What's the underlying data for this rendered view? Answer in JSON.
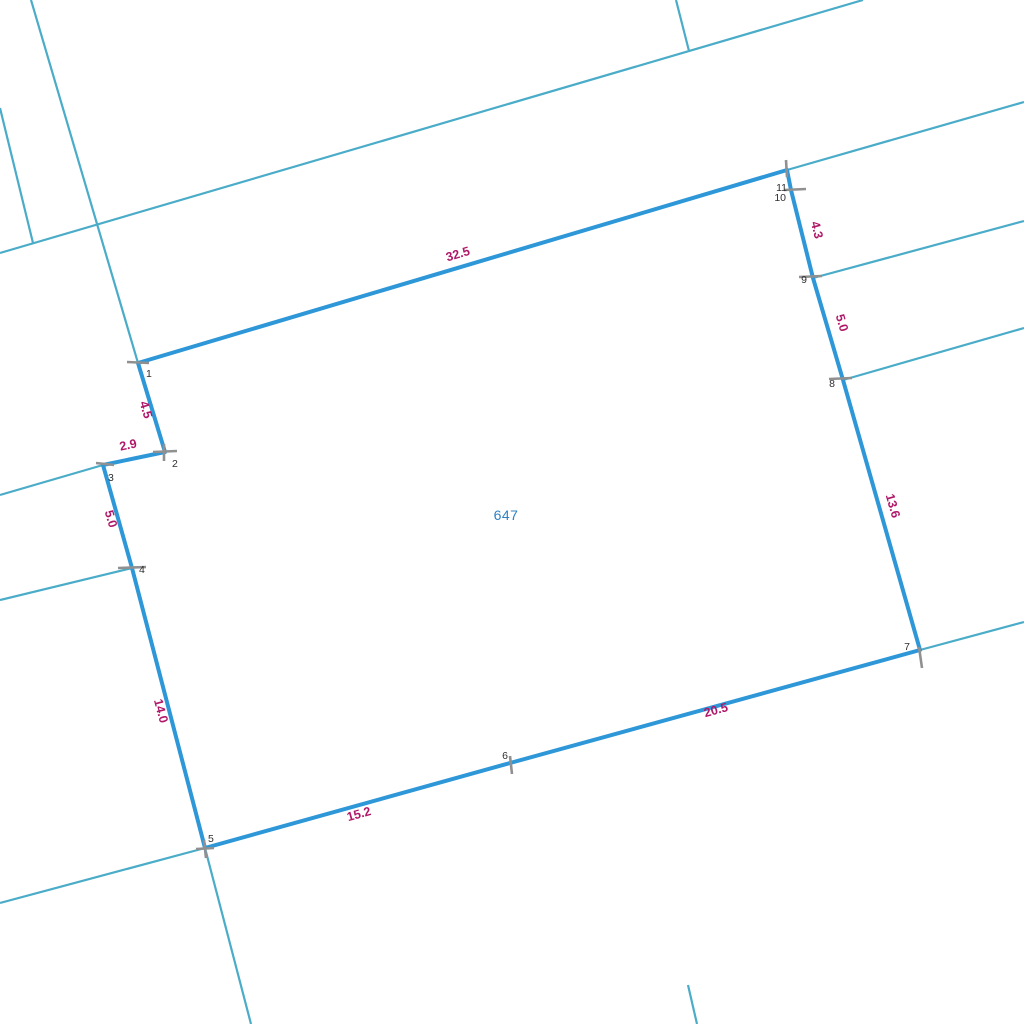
{
  "map": {
    "title": "cadastral parcel map",
    "canvas": {
      "width": 1024,
      "height": 1024,
      "background": "#ffffff"
    },
    "colors": {
      "parcel_boundary": "#2e97d8",
      "adjacent_boundary": "#4aacc8",
      "dimension_label": "#b01768",
      "vertex_label": "#2f2f2f",
      "tick": "#909090",
      "parcel_number": "#2f80c3"
    },
    "parcel": {
      "number": "647",
      "number_pos": {
        "x": 506,
        "y": 515
      },
      "vertices": [
        {
          "n": "1",
          "x": 138,
          "y": 363,
          "lx": 146,
          "ly": 377,
          "anchor": "start"
        },
        {
          "n": "2",
          "x": 165,
          "y": 452,
          "lx": 172,
          "ly": 467,
          "anchor": "start"
        },
        {
          "n": "3",
          "x": 103,
          "y": 465,
          "lx": 108,
          "ly": 481,
          "anchor": "start"
        },
        {
          "n": "4",
          "x": 132,
          "y": 568,
          "lx": 139,
          "ly": 573,
          "anchor": "start"
        },
        {
          "n": "5",
          "x": 205,
          "y": 848,
          "lx": 208,
          "ly": 842,
          "anchor": "start"
        },
        {
          "n": "6",
          "x": 510,
          "y": 763,
          "lx": 505,
          "ly": 759,
          "anchor": "middle"
        },
        {
          "n": "7",
          "x": 920,
          "y": 650,
          "lx": 910,
          "ly": 650,
          "anchor": "end"
        },
        {
          "n": "8",
          "x": 843,
          "y": 380,
          "lx": 835,
          "ly": 387,
          "anchor": "end"
        },
        {
          "n": "9",
          "x": 813,
          "y": 278,
          "lx": 807,
          "ly": 283,
          "anchor": "end"
        },
        {
          "n": "10",
          "x": 791,
          "y": 190,
          "lx": 786,
          "ly": 201,
          "anchor": "end"
        },
        {
          "n": "11",
          "x": 787,
          "y": 170,
          "lx": 787,
          "ly": 191,
          "anchor": "end"
        }
      ],
      "dimensions": [
        {
          "text": "32.5",
          "x": 459,
          "y": 258,
          "angle": -16.5
        },
        {
          "text": "4.3",
          "x": 813,
          "y": 231,
          "angle": 76
        },
        {
          "text": "5.0",
          "x": 838,
          "y": 324,
          "angle": 74
        },
        {
          "text": "13.6",
          "x": 889,
          "y": 507,
          "angle": 74
        },
        {
          "text": "20.5",
          "x": 717,
          "y": 714,
          "angle": -15.4
        },
        {
          "text": "15.2",
          "x": 360,
          "y": 818,
          "angle": -15.6
        },
        {
          "text": "14.0",
          "x": 157,
          "y": 712,
          "angle": 75
        },
        {
          "text": "5.0",
          "x": 107,
          "y": 520,
          "angle": 74
        },
        {
          "text": "2.9",
          "x": 129,
          "y": 449,
          "angle": -12
        },
        {
          "text": "4.5",
          "x": 142,
          "y": 411,
          "angle": 73
        }
      ]
    },
    "adjacent_lines": [
      {
        "x1": 31,
        "y1": 0,
        "x2": 138,
        "y2": 363
      },
      {
        "x1": 0,
        "y1": 108,
        "x2": 33,
        "y2": 243
      },
      {
        "x1": 0,
        "y1": 253,
        "x2": 863,
        "y2": 0
      },
      {
        "x1": 676,
        "y1": 0,
        "x2": 689,
        "y2": 51
      },
      {
        "x1": 1024,
        "y1": 102,
        "x2": 787,
        "y2": 170
      },
      {
        "x1": 813,
        "y1": 278,
        "x2": 1024,
        "y2": 221
      },
      {
        "x1": 843,
        "y1": 380,
        "x2": 1024,
        "y2": 328
      },
      {
        "x1": 920,
        "y1": 650,
        "x2": 1024,
        "y2": 622
      },
      {
        "x1": 0,
        "y1": 495,
        "x2": 103,
        "y2": 465
      },
      {
        "x1": 0,
        "y1": 600,
        "x2": 132,
        "y2": 568
      },
      {
        "x1": 0,
        "y1": 903,
        "x2": 205,
        "y2": 848
      },
      {
        "x1": 205,
        "y1": 848,
        "x2": 251,
        "y2": 1024
      },
      {
        "x1": 688,
        "y1": 985,
        "x2": 697,
        "y2": 1024
      }
    ],
    "ticks": [
      {
        "x1": 127,
        "y1": 362,
        "x2": 149,
        "y2": 363
      },
      {
        "x1": 153,
        "y1": 452,
        "x2": 177,
        "y2": 451
      },
      {
        "x1": 164,
        "y1": 444,
        "x2": 164,
        "y2": 461
      },
      {
        "x1": 96,
        "y1": 463,
        "x2": 114,
        "y2": 465
      },
      {
        "x1": 118,
        "y1": 568,
        "x2": 146,
        "y2": 567
      },
      {
        "x1": 196,
        "y1": 849,
        "x2": 214,
        "y2": 848
      },
      {
        "x1": 204,
        "y1": 840,
        "x2": 206,
        "y2": 858
      },
      {
        "x1": 510,
        "y1": 756,
        "x2": 512,
        "y2": 774
      },
      {
        "x1": 919,
        "y1": 647,
        "x2": 922,
        "y2": 668
      },
      {
        "x1": 829,
        "y1": 379,
        "x2": 852,
        "y2": 378
      },
      {
        "x1": 799,
        "y1": 277,
        "x2": 822,
        "y2": 276
      },
      {
        "x1": 784,
        "y1": 190,
        "x2": 806,
        "y2": 189
      },
      {
        "x1": 786,
        "y1": 160,
        "x2": 787,
        "y2": 177
      }
    ]
  }
}
